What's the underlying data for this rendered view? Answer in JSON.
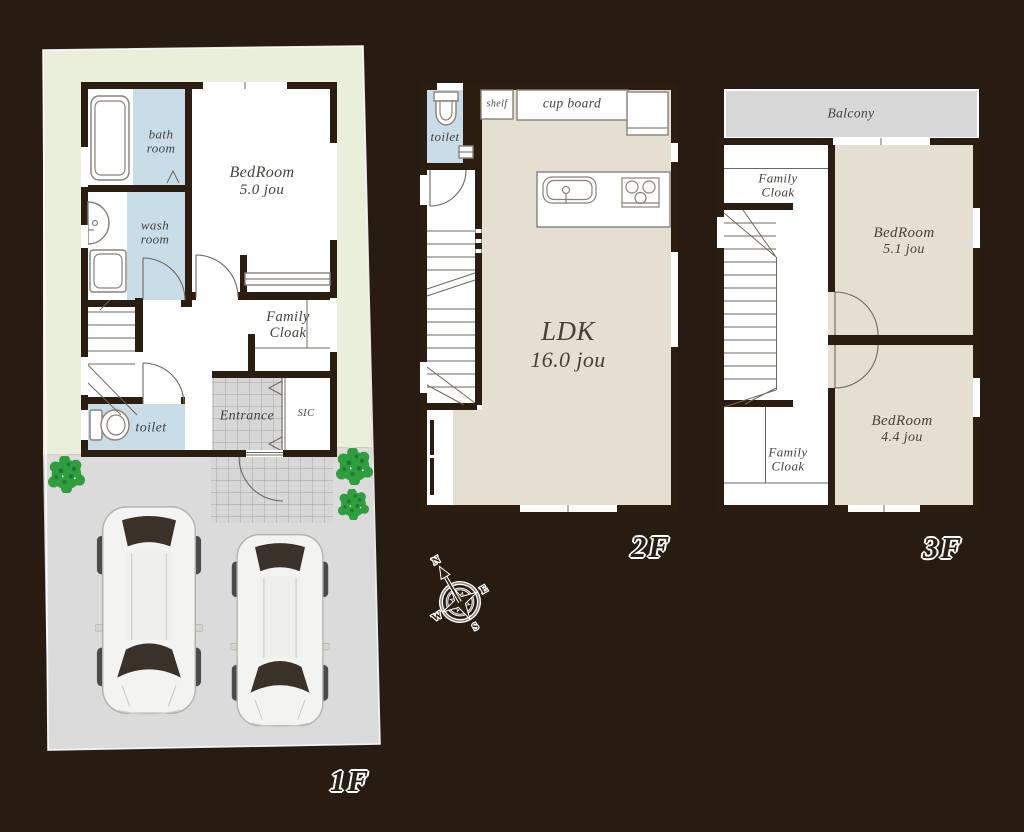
{
  "colors": {
    "background": "#281b11",
    "wall": "#2c1d11",
    "grass": "#e9efdb",
    "driveway": "#dbdbdb",
    "floor_white": "#ffffff",
    "floor_beige": "#e5dfd1",
    "wet_blue": "#c9dde9",
    "balcony": "#d8d8d8",
    "tile": "#d7d7d7",
    "tile_line": "#a3a3a3",
    "furn_line": "#8a8178",
    "thin_line": "#6f675d",
    "text": "#45413b",
    "tree": "#2f9e3e",
    "tree_dark": "#1d7c2d",
    "car_body": "#f3f3f1",
    "car_glass": "#3a3129",
    "outline": "#ffffff",
    "tag_text": "#2b1e13"
  },
  "floor1": {
    "label": "1F",
    "bathroom_l1": "bath",
    "bathroom_l2": "room",
    "washroom_l1": "wash",
    "washroom_l2": "room",
    "bedroom_l1": "BedRoom",
    "bedroom_l2": "5.0 jou",
    "family_cloak_l1": "Family",
    "family_cloak_l2": "Cloak",
    "entrance": "Entrance",
    "sic": "SIC",
    "toilet": "toilet"
  },
  "floor2": {
    "label": "2F",
    "toilet": "toilet",
    "shelf": "shelf",
    "cupboard": "cup board",
    "ldk_l1": "LDK",
    "ldk_l2": "16.0 jou"
  },
  "floor3": {
    "label": "3F",
    "balcony": "Balcony",
    "family_cloak_top_l1": "Family",
    "family_cloak_top_l2": "Cloak",
    "bedroom1_l1": "BedRoom",
    "bedroom1_l2": "5.1 jou",
    "bedroom2_l1": "BedRoom",
    "bedroom2_l2": "4.4 jou",
    "family_cloak_bottom_l1": "Family",
    "family_cloak_bottom_l2": "Cloak"
  },
  "compass": {
    "n": "N",
    "e": "E",
    "s": "S",
    "w": "W"
  }
}
